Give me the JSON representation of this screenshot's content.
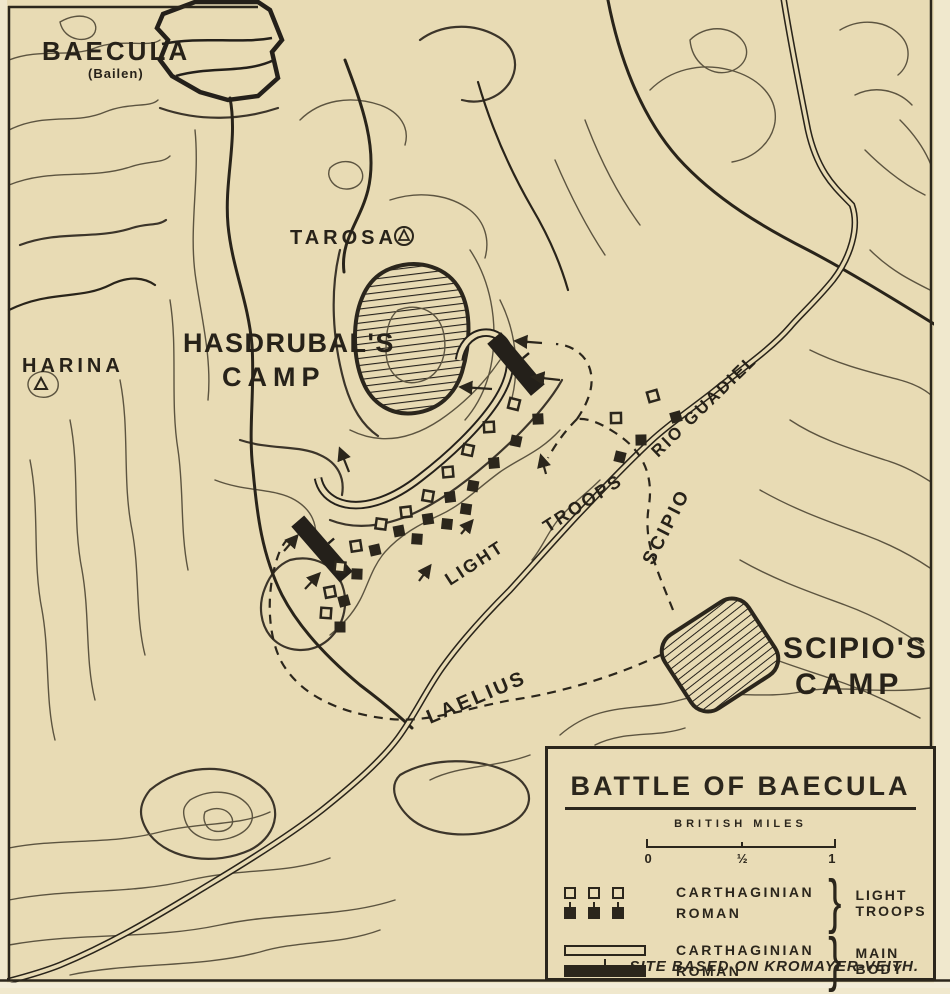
{
  "map": {
    "labels": {
      "baecula": "BAECULA",
      "baecula_sub": "(Bailen)",
      "tarosa": "TAROSA",
      "harina": "HARINA",
      "hasdrubals_camp_line1": "HASDRUBAL'S",
      "hasdrubals_camp_line2": "CAMP",
      "scipios_camp_line1": "SCIPIO'S",
      "scipios_camp_line2": "CAMP",
      "rio_guadiel": "RIO GUADIEL",
      "scipio_route": "SCIPIO",
      "light_troops_line1": "LIGHT",
      "light_troops_line2": "TROOPS",
      "laelius_route": "LAELIUS"
    },
    "markers": {
      "carthaginian_light": [
        [
          653,
          396
        ],
        [
          616,
          418
        ],
        [
          514,
          404
        ],
        [
          489,
          427
        ],
        [
          468,
          450
        ],
        [
          448,
          472
        ],
        [
          428,
          496
        ],
        [
          406,
          512
        ],
        [
          381,
          524
        ],
        [
          356,
          546
        ],
        [
          340,
          567
        ],
        [
          330,
          592
        ],
        [
          326,
          613
        ]
      ],
      "roman_light": [
        [
          676,
          417
        ],
        [
          641,
          440
        ],
        [
          620,
          457
        ],
        [
          538,
          419
        ],
        [
          516,
          441
        ],
        [
          494,
          463
        ],
        [
          473,
          486
        ],
        [
          450,
          497
        ],
        [
          466,
          509
        ],
        [
          428,
          519
        ],
        [
          447,
          524
        ],
        [
          399,
          531
        ],
        [
          417,
          539
        ],
        [
          375,
          550
        ],
        [
          357,
          574
        ],
        [
          344,
          601
        ],
        [
          340,
          627
        ]
      ]
    }
  },
  "legend": {
    "title": "BATTLE OF BAECULA",
    "scale_label": "BRITISH MILES",
    "scale_zero": "0",
    "scale_half": "½",
    "scale_one": "1",
    "entries": [
      {
        "group": "LIGHT TROOPS",
        "rows": [
          {
            "name": "CARTHAGINIAN"
          },
          {
            "name": "ROMAN"
          }
        ]
      },
      {
        "group": "MAIN BODY",
        "rows": [
          {
            "name": "CARTHAGINIAN"
          },
          {
            "name": "ROMAN"
          }
        ]
      }
    ],
    "footnote": "SITE BASED ON KROMAYER-VEITH."
  },
  "colors": {
    "paper": "#e8dbb4",
    "ink": "#2b261c",
    "contour": "#5c5440"
  }
}
